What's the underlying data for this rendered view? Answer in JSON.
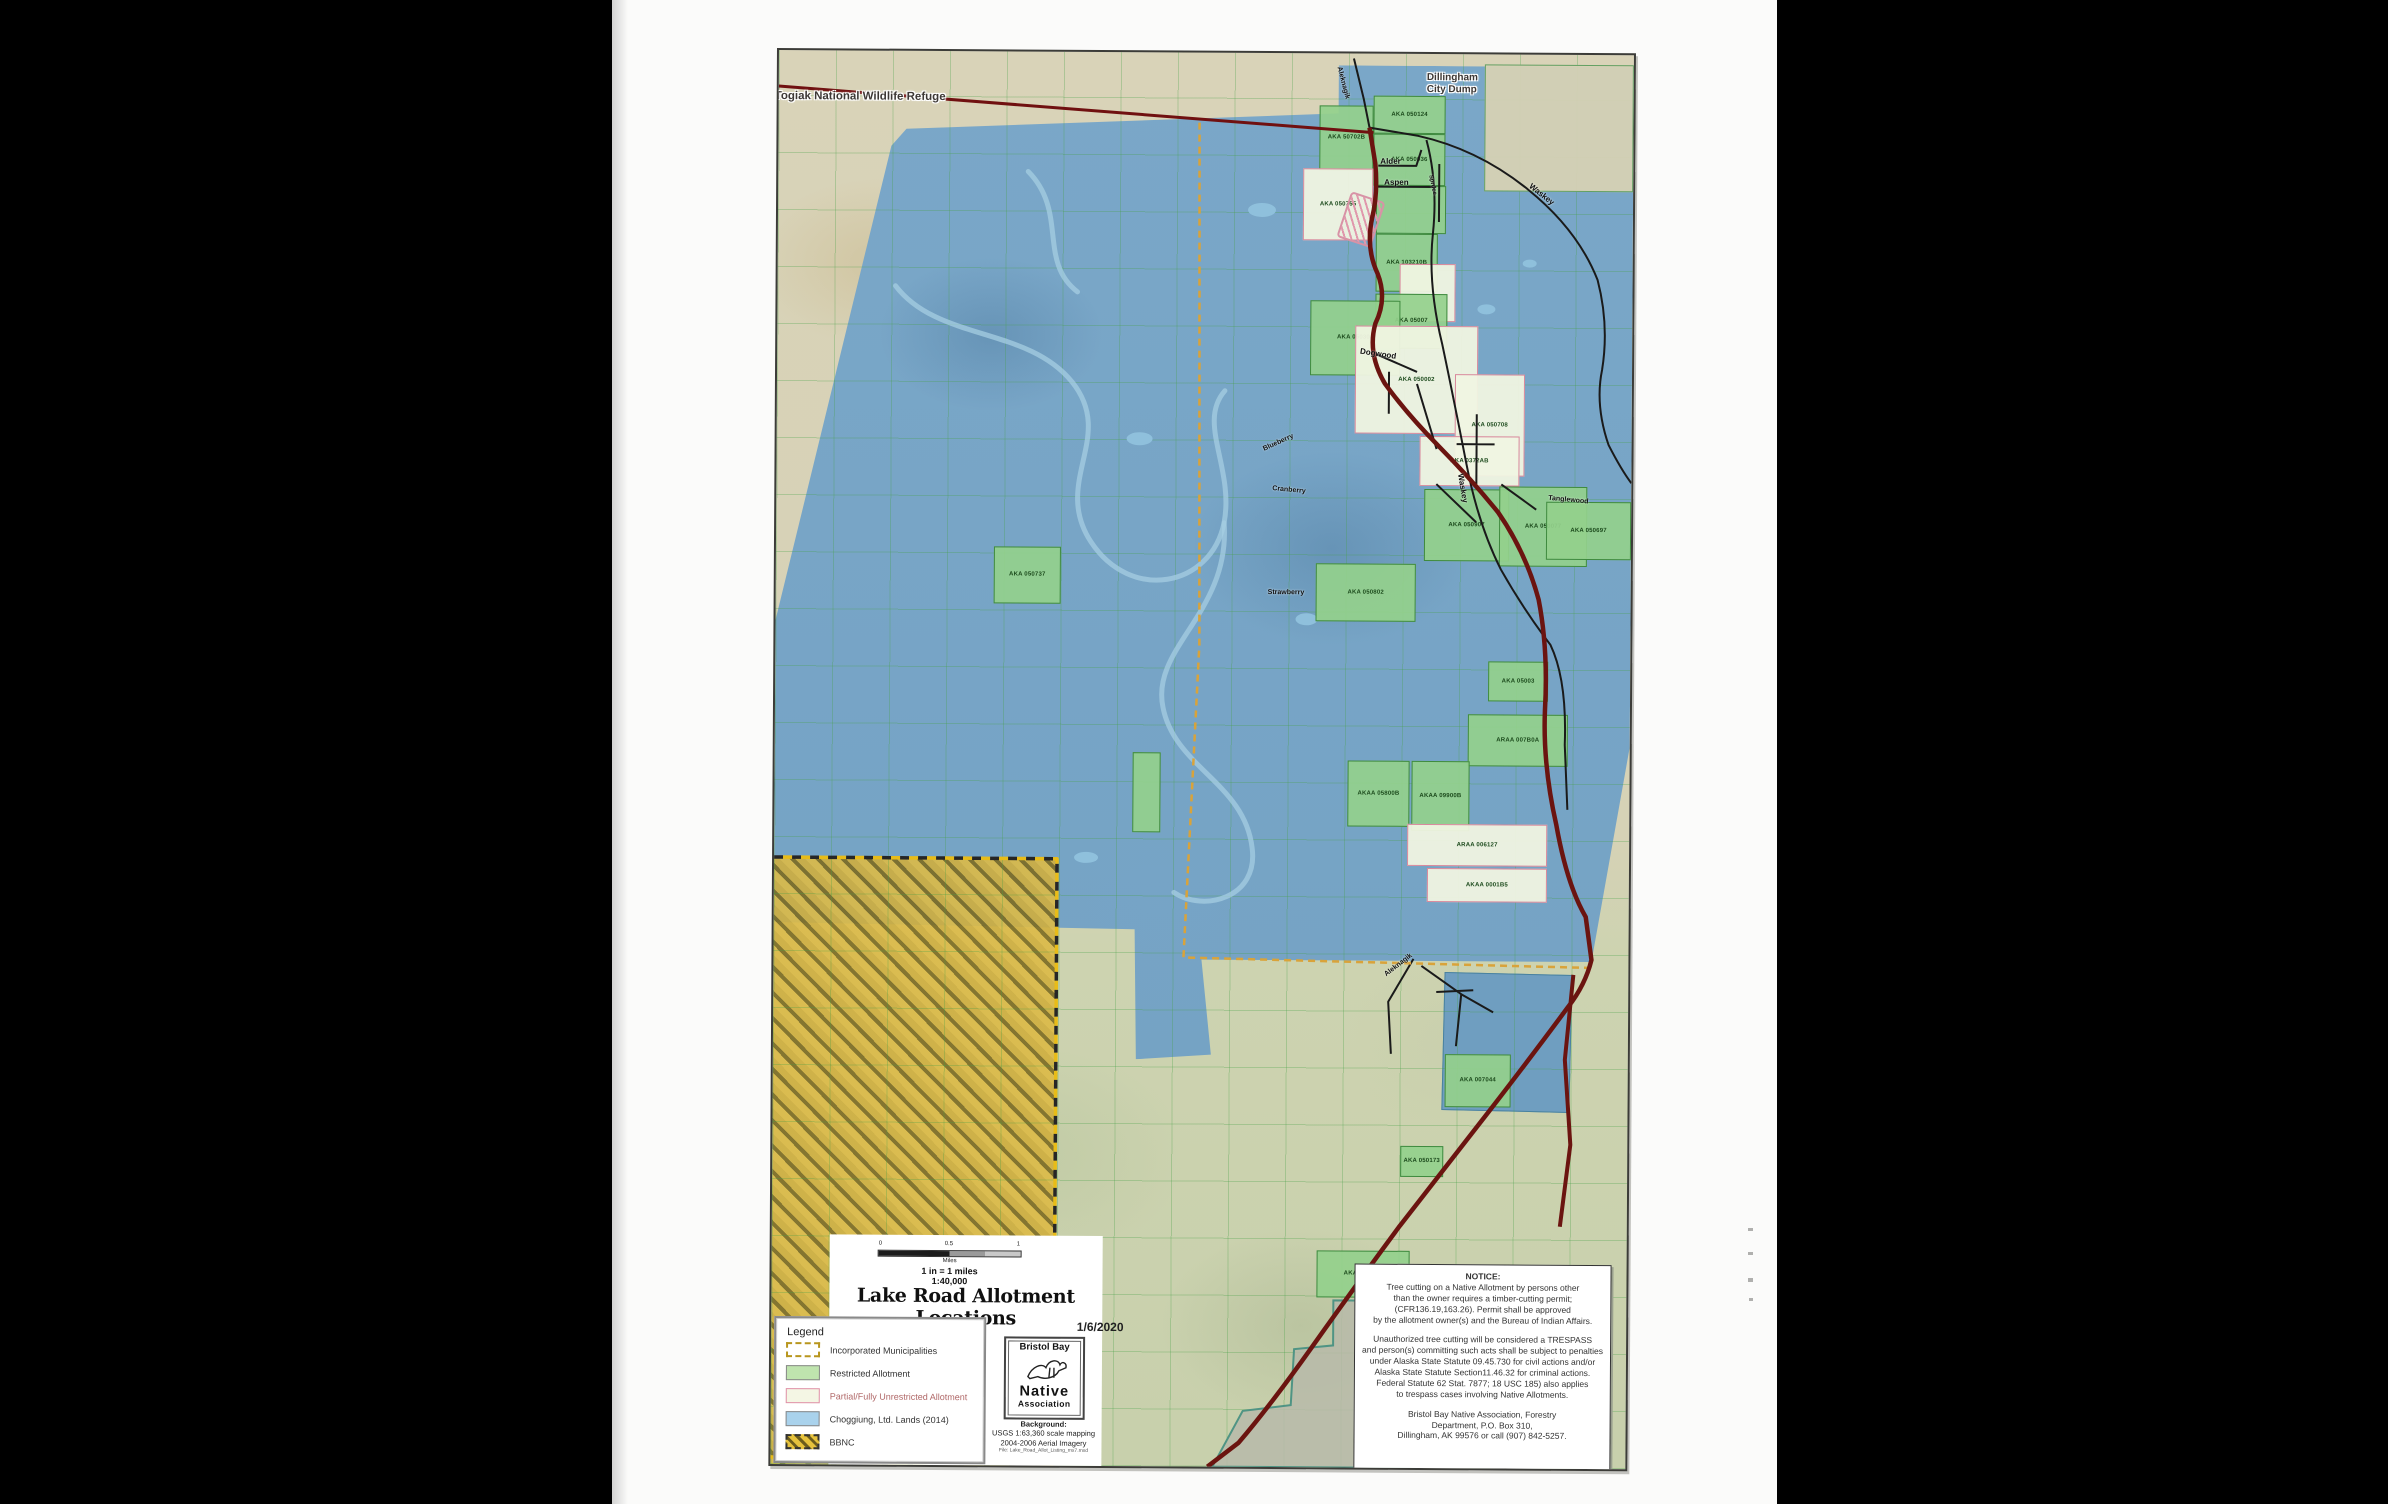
{
  "map": {
    "refuge_label": "Togiak National Wildlife Refuge",
    "dump_label_line1": "Dillingham",
    "dump_label_line2": "City Dump",
    "parcels": [
      {
        "x": 706,
        "y": 10,
        "w": 149,
        "h": 127,
        "t": "t",
        "label": ""
      },
      {
        "x": 595,
        "y": 42,
        "w": 72,
        "h": 38,
        "t": "g",
        "label": "AKA 050124"
      },
      {
        "x": 541,
        "y": 52,
        "w": 54,
        "h": 65,
        "t": "g",
        "label": "AKA 50702B"
      },
      {
        "x": 595,
        "y": 80,
        "w": 72,
        "h": 52,
        "t": "g",
        "label": "AKA 050036"
      },
      {
        "x": 525,
        "y": 115,
        "w": 70,
        "h": 72,
        "t": "p",
        "label": "AKA 050755"
      },
      {
        "x": 598,
        "y": 132,
        "w": 70,
        "h": 48,
        "t": "g",
        "label": ""
      },
      {
        "x": 598,
        "y": 180,
        "w": 62,
        "h": 58,
        "t": "g",
        "label": "AKA 103210B"
      },
      {
        "x": 622,
        "y": 210,
        "w": 56,
        "h": 58,
        "t": "p",
        "label": ""
      },
      {
        "x": 598,
        "y": 240,
        "w": 72,
        "h": 55,
        "t": "g",
        "label": "AKA 05007"
      },
      {
        "x": 533,
        "y": 247,
        "w": 90,
        "h": 75,
        "t": "g",
        "label": "AKA 050303"
      },
      {
        "x": 578,
        "y": 272,
        "w": 123,
        "h": 108,
        "t": "p",
        "label": "AKA 050002"
      },
      {
        "x": 678,
        "y": 320,
        "w": 70,
        "h": 102,
        "t": "p",
        "label": "AKA 050708"
      },
      {
        "x": 643,
        "y": 382,
        "w": 100,
        "h": 50,
        "t": "p",
        "label": "AKA 0372AB"
      },
      {
        "x": 648,
        "y": 435,
        "w": 85,
        "h": 72,
        "t": "g",
        "label": "AKA 050907"
      },
      {
        "x": 723,
        "y": 432,
        "w": 88,
        "h": 80,
        "t": "g",
        "label": "AKA 050077"
      },
      {
        "x": 770,
        "y": 447,
        "w": 85,
        "h": 58,
        "t": "g",
        "label": "AKA 050697"
      },
      {
        "x": 540,
        "y": 510,
        "w": 100,
        "h": 58,
        "t": "g",
        "label": "AKA 050802"
      },
      {
        "x": 218,
        "y": 495,
        "w": 67,
        "h": 57,
        "t": "g",
        "label": "AKA 050737"
      },
      {
        "x": 713,
        "y": 607,
        "w": 60,
        "h": 40,
        "t": "g",
        "label": "AKA 05003"
      },
      {
        "x": 693,
        "y": 660,
        "w": 100,
        "h": 52,
        "t": "g",
        "label": "ARAA 007B0A"
      },
      {
        "x": 573,
        "y": 707,
        "w": 62,
        "h": 66,
        "t": "g",
        "label": "AKAA 05800B"
      },
      {
        "x": 637,
        "y": 707,
        "w": 58,
        "h": 70,
        "t": "g",
        "label": "AKAA 09900B"
      },
      {
        "x": 358,
        "y": 700,
        "w": 28,
        "h": 80,
        "t": "g",
        "label": ""
      },
      {
        "x": 633,
        "y": 770,
        "w": 140,
        "h": 42,
        "t": "p",
        "label": "ARAA 006127"
      },
      {
        "x": 653,
        "y": 814,
        "w": 120,
        "h": 34,
        "t": "p",
        "label": "AKAA 0001B5"
      },
      {
        "x": 672,
        "y": 1000,
        "w": 66,
        "h": 53,
        "t": "g",
        "label": "AKA 007044"
      },
      {
        "x": 628,
        "y": 1092,
        "w": 43,
        "h": 31,
        "t": "g",
        "label": "AKA 050173"
      },
      {
        "x": 545,
        "y": 1197,
        "w": 93,
        "h": 47,
        "t": "g",
        "label": "AKA 0001-73"
      }
    ],
    "street_labels": [
      {
        "t": "Aleknagik",
        "x": 560,
        "y": 10,
        "r": 75,
        "s": 7
      },
      {
        "t": "Alder",
        "x": 602,
        "y": 103,
        "r": 0,
        "s": 8
      },
      {
        "t": "Aspen",
        "x": 606,
        "y": 124,
        "r": 0,
        "s": 8
      },
      {
        "t": "Spruce",
        "x": 652,
        "y": 118,
        "r": 78,
        "s": 6
      },
      {
        "t": "Waskey",
        "x": 752,
        "y": 126,
        "r": 38,
        "s": 8
      },
      {
        "t": "Waskey",
        "x": 684,
        "y": 415,
        "r": 80,
        "s": 8
      },
      {
        "t": "Dogwood",
        "x": 583,
        "y": 293,
        "r": 8,
        "s": 8
      },
      {
        "t": "Blueberry",
        "x": 487,
        "y": 393,
        "r": -25,
        "s": 7
      },
      {
        "t": "Cranberry",
        "x": 496,
        "y": 432,
        "r": 5,
        "s": 7
      },
      {
        "t": "Strawberry",
        "x": 492,
        "y": 536,
        "r": 0,
        "s": 7
      },
      {
        "t": "Tanglewood",
        "x": 772,
        "y": 440,
        "r": 5,
        "s": 7
      },
      {
        "t": "Aleknagik",
        "x": 612,
        "y": 918,
        "r": -38,
        "s": 7
      }
    ],
    "roads": [
      {
        "d": "M0,36 L595,79",
        "c": "#701010",
        "w": 3,
        "dash": ""
      },
      {
        "d": "M575,5 L585,45 L591,74",
        "c": "#1a1a1a",
        "w": 2,
        "dash": ""
      },
      {
        "d": "M591,74 L640,82 Q700,95 750,135 Q800,175 820,225 Q832,270 825,315 Q818,350 832,390 Q845,415 855,428",
        "c": "#1a1a1a",
        "w": 2,
        "dash": ""
      },
      {
        "d": "M648,86 Q660,130 655,180 Q650,230 665,290 Q678,350 690,410 Q702,470 725,515 Q748,555 775,590 Q792,625 790,690 L793,755",
        "c": "#1a1a1a",
        "w": 2,
        "dash": ""
      },
      {
        "d": "M600,112 L638,112 L643,96 M596,133 L658,133 M661,110 L661,168",
        "c": "#1a1a1a",
        "w": 2,
        "dash": ""
      },
      {
        "d": "M598,300 L640,318 M612,318 L612,360 M640,330 L660,395 M680,390 L718,390 M700,360 L700,430 M660,430 L700,468 M725,430 L760,455",
        "c": "#1a1a1a",
        "w": 2,
        "dash": ""
      },
      {
        "d": "M640,905 L615,948 L618,1000 M648,912 L688,940 L683,992 M663,938 L700,936 M688,940 L720,958",
        "c": "#1a1a1a",
        "w": 2,
        "dash": ""
      },
      {
        "d": "M421,70 L424,592 L410,905 L818,913",
        "c": "#d9a33a",
        "w": 2.5,
        "dash": "7 5"
      },
      {
        "d": "M0,807 L283,807 L283,1407 L0,1407",
        "c": "#262626",
        "w": 3.5,
        "dash": "9 9"
      },
      {
        "d": "M0,807 L283,807 L283,1407 L0,1407",
        "c": "#e8bc18",
        "w": 3.5,
        "dash": "9 9",
        "off": 9
      },
      {
        "d": "M800,920 L792,1005 L798,1090 L788,1172",
        "c": "#6b1410",
        "w": 4,
        "dash": ""
      },
      {
        "d": "M591,74 L597,110 Q600,140 594,165 Q588,195 600,220 Q610,245 598,270 Q590,300 608,330 Q630,360 662,392 Q695,425 722,458 Q750,498 763,545 Q773,595 770,655 Q768,710 782,770 Q793,830 812,862 L818,905 Q812,930 795,952 Q760,1000 718,1055 Q672,1115 628,1172 Q582,1235 540,1295 Q500,1352 468,1390 L437,1414",
        "c": "#6b1410",
        "w": 4.5,
        "dash": ""
      }
    ],
    "rivers": [
      {
        "d": "M118,235 C160,290 250,275 295,330 C340,385 275,430 315,490 C355,550 435,535 448,470 C458,415 420,370 448,338"
      },
      {
        "d": "M448,470 C455,560 375,595 388,655 C400,715 470,730 478,795 C485,845 430,860 400,840"
      },
      {
        "d": "M250,120 C290,160 260,210 300,240"
      }
    ],
    "gray_region": {
      "d": "M562,1247 L640,1247 L640,1414 L442,1414 L472,1358 L520,1352 L523,1296 L562,1292 Z",
      "fill": "#b7baa9",
      "stroke": "#4f9484"
    },
    "lakes": [
      {
        "x": 470,
        "y": 150,
        "w": 28,
        "h": 14
      },
      {
        "x": 520,
        "y": 560,
        "w": 22,
        "h": 12
      },
      {
        "x": 350,
        "y": 380,
        "w": 26,
        "h": 13
      },
      {
        "x": 300,
        "y": 800,
        "w": 24,
        "h": 11
      },
      {
        "x": 700,
        "y": 250,
        "w": 18,
        "h": 10
      },
      {
        "x": 745,
        "y": 205,
        "w": 14,
        "h": 8
      }
    ]
  },
  "title_block": {
    "title": "Lake Road Allotment Locations",
    "date": "1/6/2020",
    "scale_ticks": [
      "0",
      "0.5",
      "1"
    ],
    "scale_unit": "Miles",
    "scale_line1": "1 in = 1 miles",
    "scale_line2": "1:40,000"
  },
  "legend": {
    "title": "Legend",
    "items": [
      {
        "label": "Incorporated Municipalities"
      },
      {
        "label": "Restricted Allotment"
      },
      {
        "label": "Partial/Fully Unrestricted Allotment"
      },
      {
        "label": "Choggiung, Ltd. Lands (2014)"
      },
      {
        "label": "BBNC"
      }
    ]
  },
  "logo": {
    "line1": "Bristol Bay",
    "line2": "Native",
    "line3": "Association"
  },
  "background_note": {
    "line1": "Background:",
    "line2": "USGS 1:63,360 scale mapping",
    "line3": "2004-2006 Aerial Imagery",
    "line4": "File: Lake_Road_Allot_Listing_mx7.mxd"
  },
  "notice": {
    "heading": "NOTICE:",
    "para1": "Tree cutting on a Native Allotment by persons other\nthan the owner requires a timber-cutting permit;\n(CFR136.19,163.26). Permit shall be approved\nby the allotment owner(s) and the Bureau of Indian Affairs.",
    "para2": "Unauthorized tree cutting will be  considered a TRESPASS\nand person(s) committing such acts shall be subject to penalties\nunder Alaska State Statute 09.45.730 for civil actions and/or\nAlaska State Statute Section11.46.32 for criminal actions.\nFederal Statute 62 Stat. 7877; 18 USC 185) also applies\nto trespass cases involving Native Allotments.",
    "para3": "Bristol Bay Native Association, Forestry\nDepartment, P.O. Box 310,\nDillingham, AK 99576 or call (907) 842-5257."
  }
}
